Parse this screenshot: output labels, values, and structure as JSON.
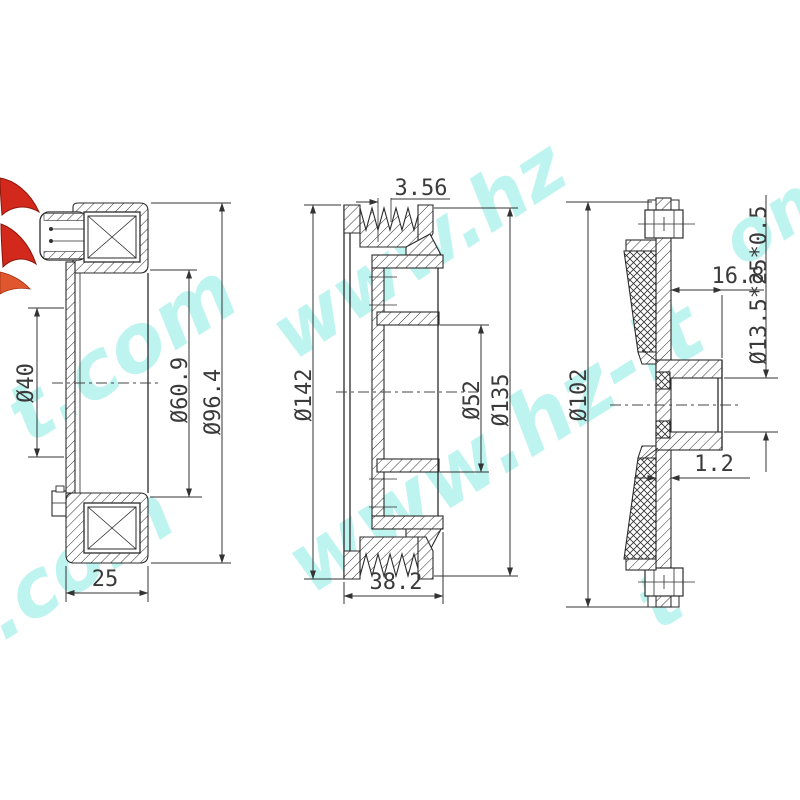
{
  "drawing": {
    "type": "technical drawing - automotive AC compressor clutch assembly, three sectional views",
    "views": {
      "coil": {
        "dim_bore": "Ø40",
        "dim_coil_id": "Ø60.9",
        "dim_od": "Ø96.4",
        "dim_width": "25"
      },
      "pulley": {
        "dim_groove_pitch": "3.56",
        "dim_od": "Ø142",
        "dim_bearing_bore": "Ø52",
        "dim_groove_od": "Ø135",
        "dim_width": "38.2"
      },
      "hub": {
        "dim_od": "Ø102",
        "dim_hub_length": "16.8",
        "dim_thread": "Ø13.5*25*0.5",
        "dim_plate_thickness": "1.2"
      }
    },
    "watermark": {
      "color": "#7de8e0",
      "fragments": {
        "a": "t.com",
        "b": "www.hz",
        "b2": "om",
        "d": "www.hz-lt",
        "e": "t.com",
        "f": "t"
      }
    }
  }
}
